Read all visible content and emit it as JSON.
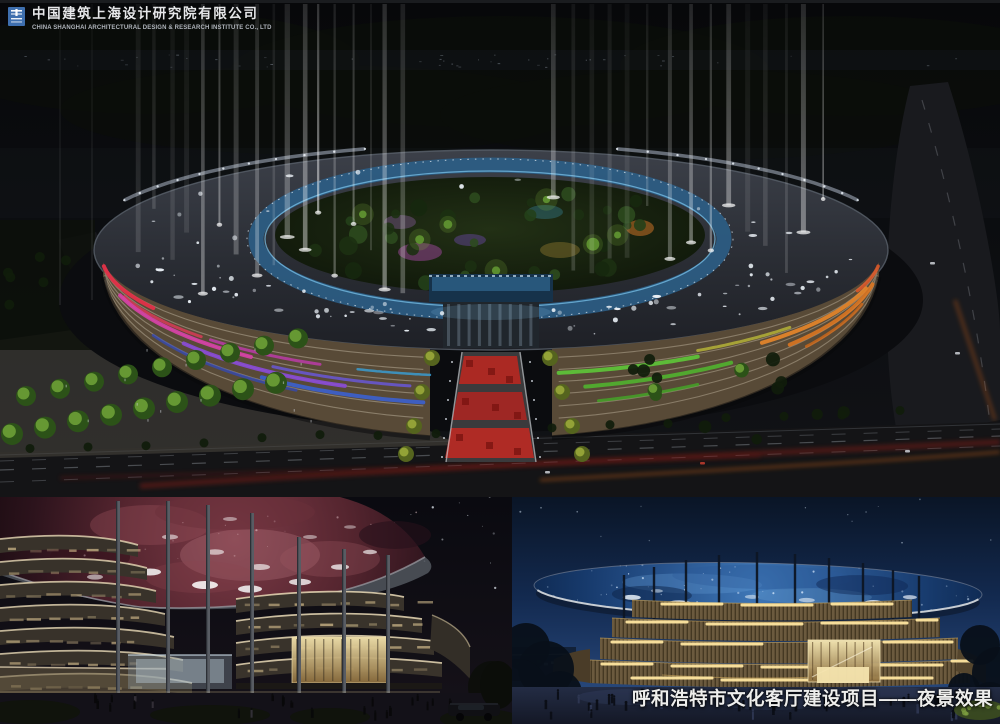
{
  "window": {
    "width": 1000,
    "height": 724
  },
  "header": {
    "logo_icon": "cscec-logo",
    "company_name_cn": "中国建筑上海设计研究院有限公司",
    "company_name_en": "CHINA SHANGHAI ARCHITECTURAL DESIGN & RESEARCH INSTITUTE CO., LTD"
  },
  "caption": {
    "text": "呼和浩特市文化客厅建设项目——夜景效果"
  },
  "panels": {
    "main": {
      "label": "aerial-night-rendering"
    },
    "bottom_left": {
      "label": "nebula-canopy-rendering"
    },
    "bottom_right": {
      "label": "starlit-canopy-plaza-rendering"
    }
  },
  "palette": {
    "logo_blue": "#3e6fae",
    "night_sky": "#0a0b0e",
    "deep_blue_sky": "#12284e",
    "galaxy_canopy_blue": "#2a5a9a",
    "nebula_canopy_red": "#7a3642",
    "facade_stripe_red": "#e23048",
    "facade_stripe_magenta": "#d840a8",
    "facade_stripe_purple": "#8a4ad8",
    "facade_stripe_blue": "#3a62d8",
    "facade_stripe_green": "#5ec838",
    "facade_stripe_orange": "#e8862a",
    "warm_floor_light": "#ffe6a0",
    "caption_text": "#eeeeec"
  }
}
